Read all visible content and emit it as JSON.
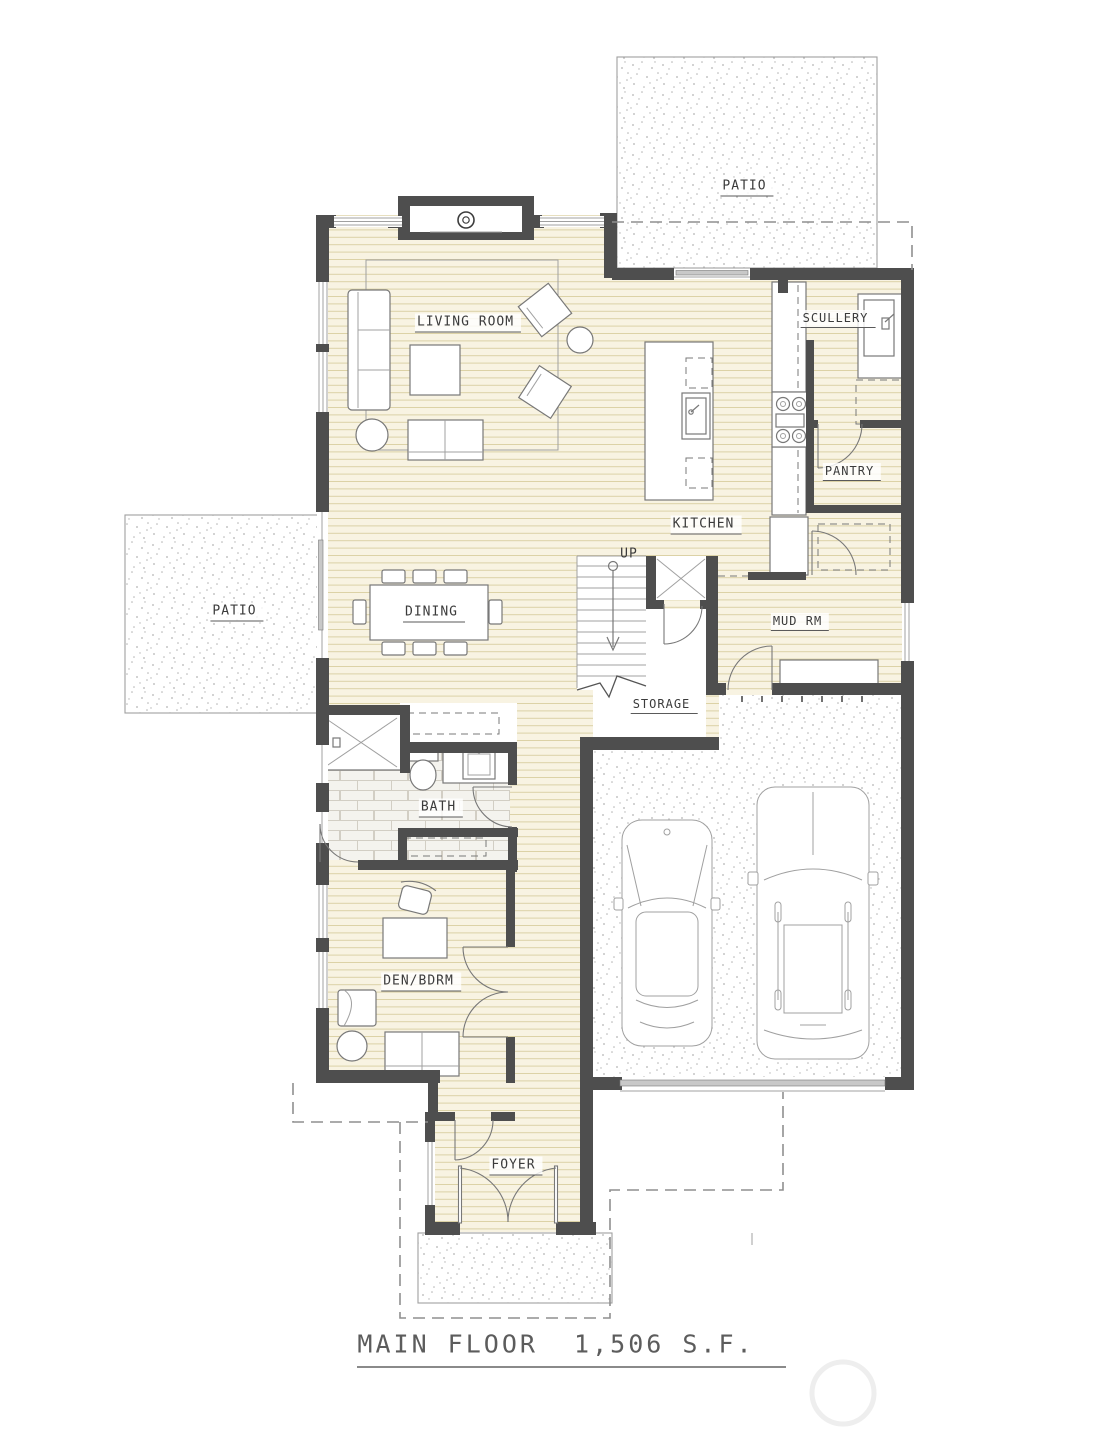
{
  "document": {
    "title_line": "MAIN FLOOR  1,506 S.F."
  },
  "rooms": {
    "patio_upper": "PATIO",
    "living_room": "LIVING ROOM",
    "scullery": "SCULLERY",
    "pantry": "PANTRY",
    "kitchen": "KITCHEN",
    "stairs_direction": "UP",
    "dining": "DINING",
    "mud_room": "MUD RM",
    "patio_left": "PATIO",
    "storage": "STORAGE",
    "bath": "BATH",
    "den_bedroom": "DEN/BDRM",
    "foyer": "FOYER"
  },
  "colors": {
    "paper": "#ffffff",
    "wall": "#4e4e4e",
    "wood_bg": "#f8f3e2",
    "wood_line": "#dbd1a6",
    "tile_bg": "#f4f3ee",
    "tile_line": "#d2cec4",
    "stipple": "#b4b4b4",
    "line": "#787878",
    "line_light": "#a0a0a0",
    "glass": "#c8c8c8",
    "dash": "#8f8f8f",
    "label": "#3b3b3b",
    "title": "#5c5c5c",
    "watermark": "#eeeeee"
  }
}
